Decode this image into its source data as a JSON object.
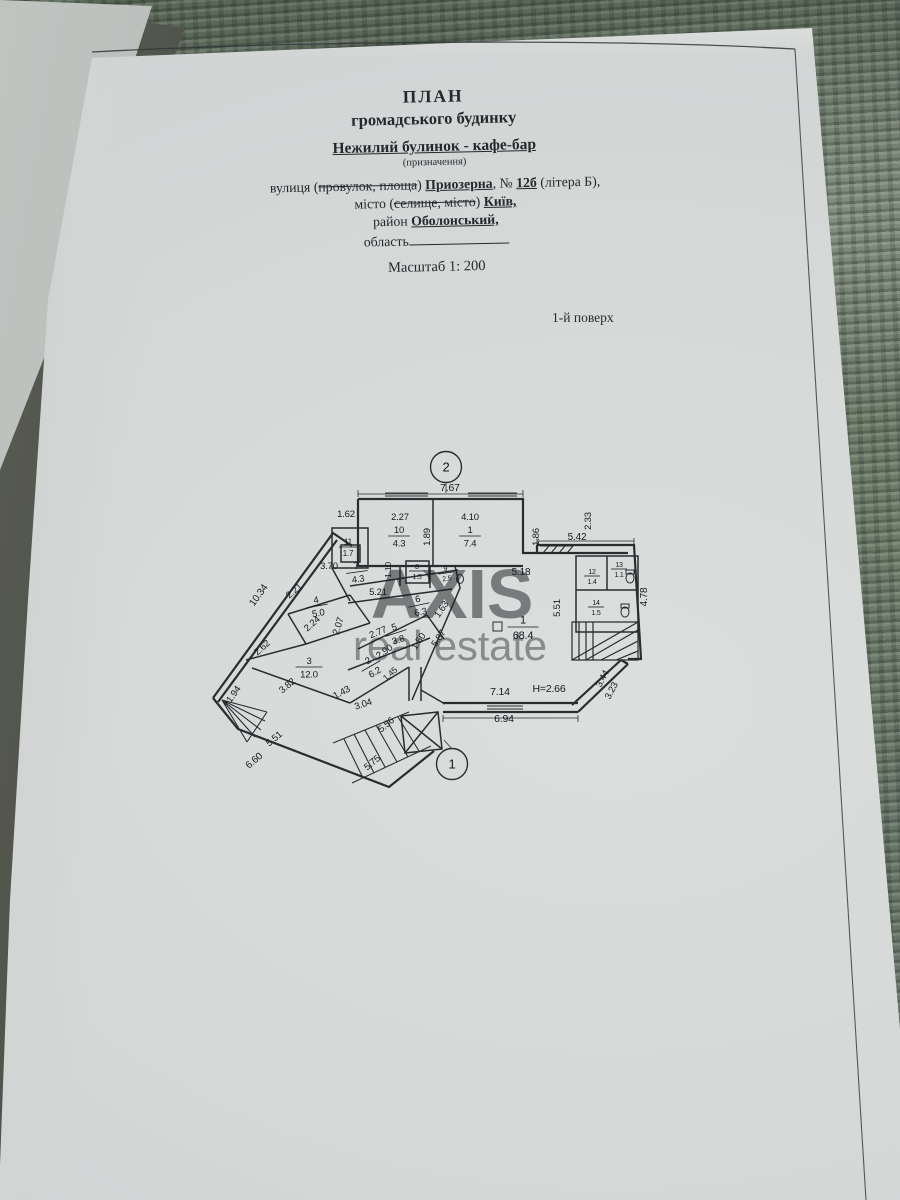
{
  "colors": {
    "paper": "#d6d8d8",
    "fabric": "#6e7d6e",
    "ink": "#26272c",
    "wall": "#2b2c30",
    "watermark": "#ffffff"
  },
  "document": {
    "title1": "ПЛАН",
    "title2": "громадського будинку",
    "subtitle": "Нежилий булинок - кафе-бар",
    "subtitle_note": "(призначення)",
    "scale": "Масштаб 1: 200",
    "floor_label": "1-й поверх",
    "street": [
      {
        "t": "вулиця ("
      },
      {
        "t": "провулок, площа",
        "s": "st"
      },
      {
        "t": ") "
      },
      {
        "t": "Приозерна",
        "s": "bu"
      },
      {
        "t": ", № "
      },
      {
        "t": "12б",
        "s": "bu"
      },
      {
        "t": " (літера Б),"
      }
    ],
    "city": [
      {
        "t": "місто ("
      },
      {
        "t": "селище, місто",
        "s": "st"
      },
      {
        "t": ") "
      },
      {
        "t": "Київ,",
        "s": "bu"
      }
    ],
    "district": [
      {
        "t": "район "
      },
      {
        "t": "Оболонський,",
        "s": "bu"
      }
    ],
    "region": [
      {
        "t": "область"
      },
      {
        "t": "",
        "s": "blank"
      }
    ]
  },
  "watermark": {
    "line1": "AXIS",
    "line2": "real estate"
  },
  "plan": {
    "markers": [
      {
        "label": "2",
        "x": 446,
        "y": 467
      },
      {
        "label": "1",
        "x": 452,
        "y": 764
      }
    ],
    "rooms": [
      {
        "n": "10",
        "a": "4.3",
        "x": 399,
        "y": 536
      },
      {
        "n": "1",
        "a": "7.4",
        "x": 470,
        "y": 536
      },
      {
        "n": "11",
        "a": "1.7",
        "x": 348,
        "y": 547,
        "fs": 8
      },
      {
        "n": "7",
        "a": "4.3",
        "x": 357,
        "y": 572,
        "rot": -8
      },
      {
        "n": "8",
        "a": "1.5",
        "x": 417,
        "y": 571,
        "fs": 7
      },
      {
        "n": "9",
        "a": "2.5",
        "x": 446,
        "y": 573,
        "fs": 7,
        "rot": -8
      },
      {
        "n": "6",
        "a": "6.3",
        "x": 419,
        "y": 605,
        "rot": -12
      },
      {
        "n": "4",
        "a": "5.0",
        "x": 317,
        "y": 606,
        "rot": -10
      },
      {
        "n": "5",
        "a": "3.8",
        "x": 396,
        "y": 633,
        "rot": -18
      },
      {
        "n": "2",
        "a": "6.2",
        "x": 371,
        "y": 666,
        "rot": -30
      },
      {
        "n": "3",
        "a": "12.0",
        "x": 309,
        "y": 667
      },
      {
        "n": "1",
        "a": "68.4",
        "x": 523,
        "y": 627,
        "fs": 11
      },
      {
        "n": "12",
        "a": "1.4",
        "x": 592,
        "y": 576,
        "fs": 7
      },
      {
        "n": "13",
        "a": "1.1",
        "x": 619,
        "y": 569,
        "fs": 7
      },
      {
        "n": "14",
        "a": "1.5",
        "x": 596,
        "y": 607,
        "fs": 7
      }
    ],
    "dims": [
      {
        "t": "7.67",
        "x": 450,
        "y": 491,
        "fs": 10.5
      },
      {
        "t": "1.62",
        "x": 346,
        "y": 517
      },
      {
        "t": "2.27",
        "x": 400,
        "y": 520
      },
      {
        "t": "4.10",
        "x": 470,
        "y": 520
      },
      {
        "t": "1.89",
        "x": 430,
        "y": 537,
        "r": -90
      },
      {
        "t": "1.86",
        "x": 539,
        "y": 537,
        "r": -90
      },
      {
        "t": "2.33",
        "x": 591,
        "y": 521,
        "r": -90
      },
      {
        "t": "5.42",
        "x": 577,
        "y": 540,
        "fs": 10
      },
      {
        "t": "3.70",
        "x": 329,
        "y": 569
      },
      {
        "t": "1.10",
        "x": 391,
        "y": 570,
        "r": -90,
        "fs": 8.5
      },
      {
        "t": "5.18",
        "x": 521,
        "y": 575,
        "fs": 10
      },
      {
        "t": "5.51",
        "x": 560,
        "y": 608,
        "r": -90
      },
      {
        "t": "4.78",
        "x": 647,
        "y": 597,
        "r": -90,
        "fs": 10
      },
      {
        "t": "5.21",
        "x": 378,
        "y": 595
      },
      {
        "t": "2.21",
        "x": 296,
        "y": 593,
        "r": -42
      },
      {
        "t": "10.34",
        "x": 261,
        "y": 597,
        "r": -54,
        "fs": 10
      },
      {
        "t": "2.24",
        "x": 314,
        "y": 626,
        "r": -42
      },
      {
        "t": "2.62",
        "x": 264,
        "y": 650,
        "r": -42
      },
      {
        "t": "2.07",
        "x": 341,
        "y": 627,
        "r": -72
      },
      {
        "t": "1.63",
        "x": 444,
        "y": 611,
        "r": -56
      },
      {
        "t": "2.77",
        "x": 379,
        "y": 635,
        "r": -22
      },
      {
        "t": "1.50",
        "x": 421,
        "y": 643,
        "r": -56
      },
      {
        "t": "5.87",
        "x": 441,
        "y": 640,
        "r": -56
      },
      {
        "t": "2.90",
        "x": 386,
        "y": 654,
        "r": -35
      },
      {
        "t": "1.45",
        "x": 392,
        "y": 676,
        "r": -42,
        "fs": 8.5
      },
      {
        "t": "3.82",
        "x": 289,
        "y": 688,
        "r": -40
      },
      {
        "t": "1.43",
        "x": 343,
        "y": 695,
        "r": -28
      },
      {
        "t": "3.04",
        "x": 364,
        "y": 707,
        "r": -18
      },
      {
        "t": "1.94",
        "x": 236,
        "y": 696,
        "r": -55
      },
      {
        "t": "5.51",
        "x": 276,
        "y": 741,
        "r": -40
      },
      {
        "t": "6.60",
        "x": 256,
        "y": 763,
        "r": -40,
        "fs": 10
      },
      {
        "t": "5.56",
        "x": 388,
        "y": 727,
        "r": -40
      },
      {
        "t": "5.75",
        "x": 374,
        "y": 765,
        "r": -40
      },
      {
        "t": "7.14",
        "x": 500,
        "y": 695,
        "fs": 10.5
      },
      {
        "t": "Н=2.66",
        "x": 549,
        "y": 692,
        "fs": 10.5
      },
      {
        "t": "6.94",
        "x": 504,
        "y": 722,
        "fs": 10.5
      },
      {
        "t": "3.44",
        "x": 605,
        "y": 680,
        "r": -62
      },
      {
        "t": "3.23",
        "x": 614,
        "y": 692,
        "r": -62
      }
    ]
  }
}
